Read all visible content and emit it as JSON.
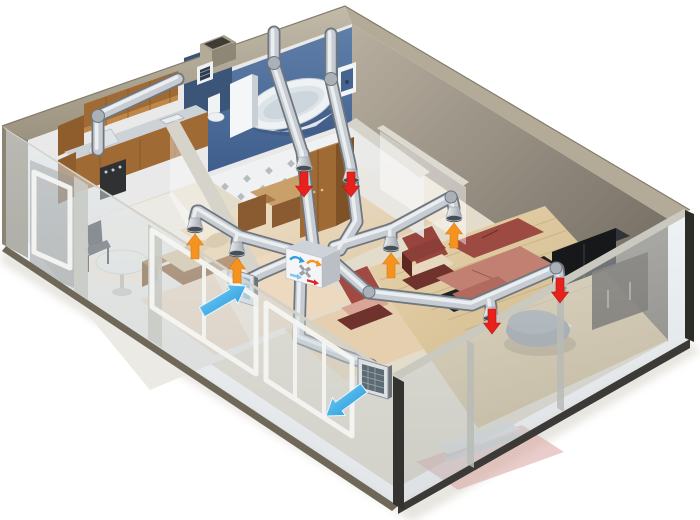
{
  "colors": {
    "background": "#ffffff",
    "wall_band": "#b3ab98",
    "wall_band_shadow": "#8f8775",
    "wall_cap": "#8c8474",
    "wall_inner": "#e8e9e8",
    "bath_wall": "#52709c",
    "bath_wall_dark": "#3b5578",
    "tile": "#eff1f2",
    "tile_dot": "#b7bcc1",
    "wood": "#a06a34",
    "wood_dark": "#7d5226",
    "wood_light": "#c08848",
    "counter": "#cdd2d6",
    "steel_light": "#eff2f4",
    "steel_mid": "#c6ccd2",
    "steel_dark": "#6f767e",
    "floor_base": "#e3dccb",
    "floor_kitchen": "#eceae4",
    "floor_hall": "#ead9bf",
    "floor_bedroom": "#edd8c0",
    "floor_living": "#ddc79d",
    "floor_living_line": "#c4ab7f",
    "glass_tint": "#cfd7dc",
    "glass_edge": "#6f6858",
    "sofa": "#9c4a42",
    "sofa_light": "#c28073",
    "sofa_dark": "#7c352e",
    "sofa_base": "#212224",
    "daybed": "#d8c49c",
    "tv_black": "#17181a",
    "ottoman": "#8d949b",
    "unit_face": "#f4f5f6",
    "unit_top": "#cdd3d8",
    "unit_side": "#b9bfc5",
    "grille_frame": "#dde1e4",
    "grille_mesh_fresh": "#8fb8d8",
    "grille_mesh_out": "#5d6a72",
    "partition_white": "#f4f6f7",
    "rug_pink": "#d8a5a0",
    "table_white": "#e9ebe6"
  },
  "airflow": {
    "fresh_air_color": "#2aa9e9",
    "supply_color": "#f6921e",
    "extract_color": "#e8211d",
    "fresh_air_arrows": 2,
    "supply_arrows": 4,
    "extract_arrows": 4
  },
  "hrv_unit": {
    "icons": [
      {
        "name": "fresh-air-curve-arrow-icon",
        "color": "#2f9de0"
      },
      {
        "name": "exhaust-curve-arrow-icon",
        "color": "#f6921e"
      },
      {
        "name": "heat-exchanger-cross-icon",
        "color": "#9aa0a6"
      },
      {
        "name": "supply-straight-arrow-icon",
        "color": "#7fc4ee"
      },
      {
        "name": "extract-straight-arrow-icon",
        "color": "#e32421"
      }
    ]
  }
}
